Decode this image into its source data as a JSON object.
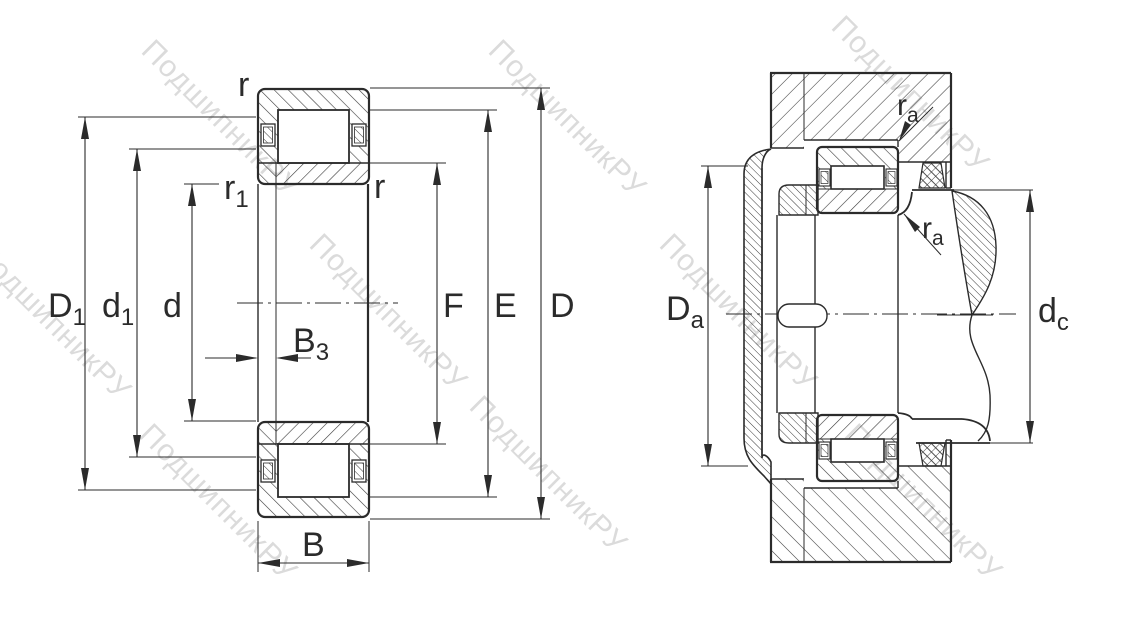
{
  "drawing": {
    "type": "bearing technical drawing",
    "views": [
      "cross-section with boundary dimensions",
      "mounting arrangement with abutment dimensions"
    ]
  },
  "watermark": {
    "text": "ПодшипникРУ",
    "color": "#bfbfbf"
  },
  "colors": {
    "line": "#2b2b2b",
    "background": "#ffffff"
  },
  "labels": {
    "left": {
      "r_top": "r",
      "r1_base": "r",
      "r1_sub": "1",
      "r_right": "r",
      "D1_base": "D",
      "D1_sub": "1",
      "d1_base": "d",
      "d1_sub": "1",
      "d": "d",
      "B3_base": "B",
      "B3_sub": "3",
      "B": "B",
      "F": "F",
      "E": "E",
      "D": "D"
    },
    "right": {
      "Da_base": "D",
      "Da_sub": "a",
      "ra_top_base": "r",
      "ra_top_sub": "a",
      "ra_bot_base": "r",
      "ra_bot_sub": "a",
      "dc_base": "d",
      "dc_sub": "c"
    }
  }
}
